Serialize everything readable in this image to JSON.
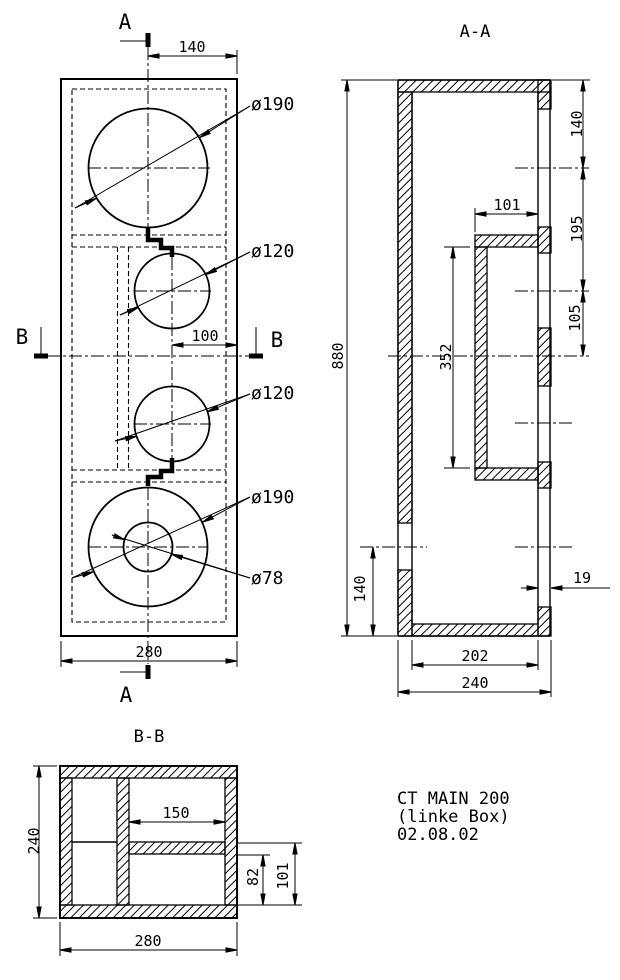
{
  "drawing": {
    "front_view": {
      "cut_a_top": "A",
      "cut_a_bottom": "A",
      "cut_b_left": "B",
      "cut_b_right": "B",
      "dim_top_offset": "140",
      "dim_mid_offset": "100",
      "dim_width": "280",
      "dia_top": "ø190",
      "dia_mid_upper": "ø120",
      "dia_mid_lower": "ø120",
      "dia_bottom": "ø190",
      "dia_port": "ø78"
    },
    "section_aa": {
      "title": "A-A",
      "dim_height": "880",
      "dim_seg_top": "140",
      "dim_seg_mid": "195",
      "dim_seg_low": "105",
      "dim_chamber_depth": "101",
      "dim_chamber_height": "352",
      "dim_port_height": "140",
      "dim_wall": "19",
      "dim_inner_depth": "202",
      "dim_depth": "240"
    },
    "section_bb": {
      "title": "B-B",
      "dim_depth": "240",
      "dim_width": "280",
      "dim_chamber_width": "150",
      "dim_shelf_low": "82",
      "dim_shelf_high": "101"
    },
    "title_block": {
      "line1": "CT MAIN 200",
      "line2": "(linke Box)",
      "line3": "02.08.02"
    }
  }
}
